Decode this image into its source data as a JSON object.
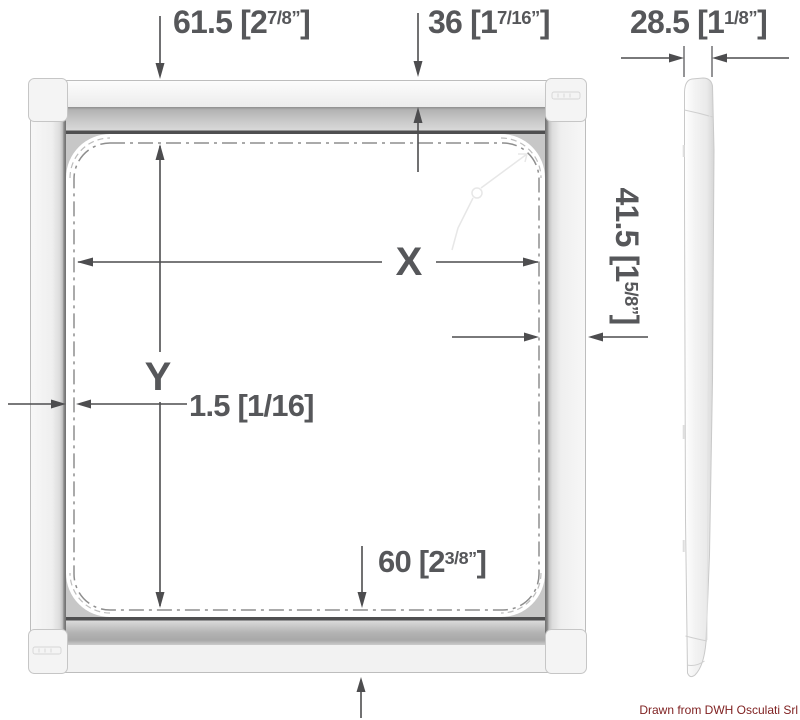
{
  "labels": {
    "dim_top_left": {
      "prefix": "61.5 [2",
      "sup": "7/8”",
      "suffix": "]"
    },
    "dim_top_mid": {
      "prefix": "36 [1",
      "sup": "7/16”",
      "suffix": "]"
    },
    "dim_top_right": {
      "prefix": "28.5 [1",
      "sup": "1/8”",
      "suffix": "]"
    },
    "dim_right_side": {
      "prefix": "41.5 [1",
      "sup": "5/8”",
      "suffix": "]"
    },
    "dim_cutout_width_label": "X",
    "dim_cutout_height_label": "Y",
    "dim_flange_offset": {
      "prefix": "1.5 [1/16]",
      "sup": "",
      "suffix": ""
    },
    "dim_bottom": {
      "prefix": "60 [2",
      "sup": "3/8”",
      "suffix": "]"
    },
    "credit": "Drawn from DWH Osculati Srl"
  },
  "colors": {
    "dimension_text": "#56575a",
    "dimension_line": "#4d4d4f",
    "credit_text": "#7e1f1f",
    "frame_outline": "#bdbdbd",
    "dash_dot_line": "#8e8e8e",
    "frame_fill": "#f2f2f2",
    "corner_fillet": "#c7c7c7"
  }
}
